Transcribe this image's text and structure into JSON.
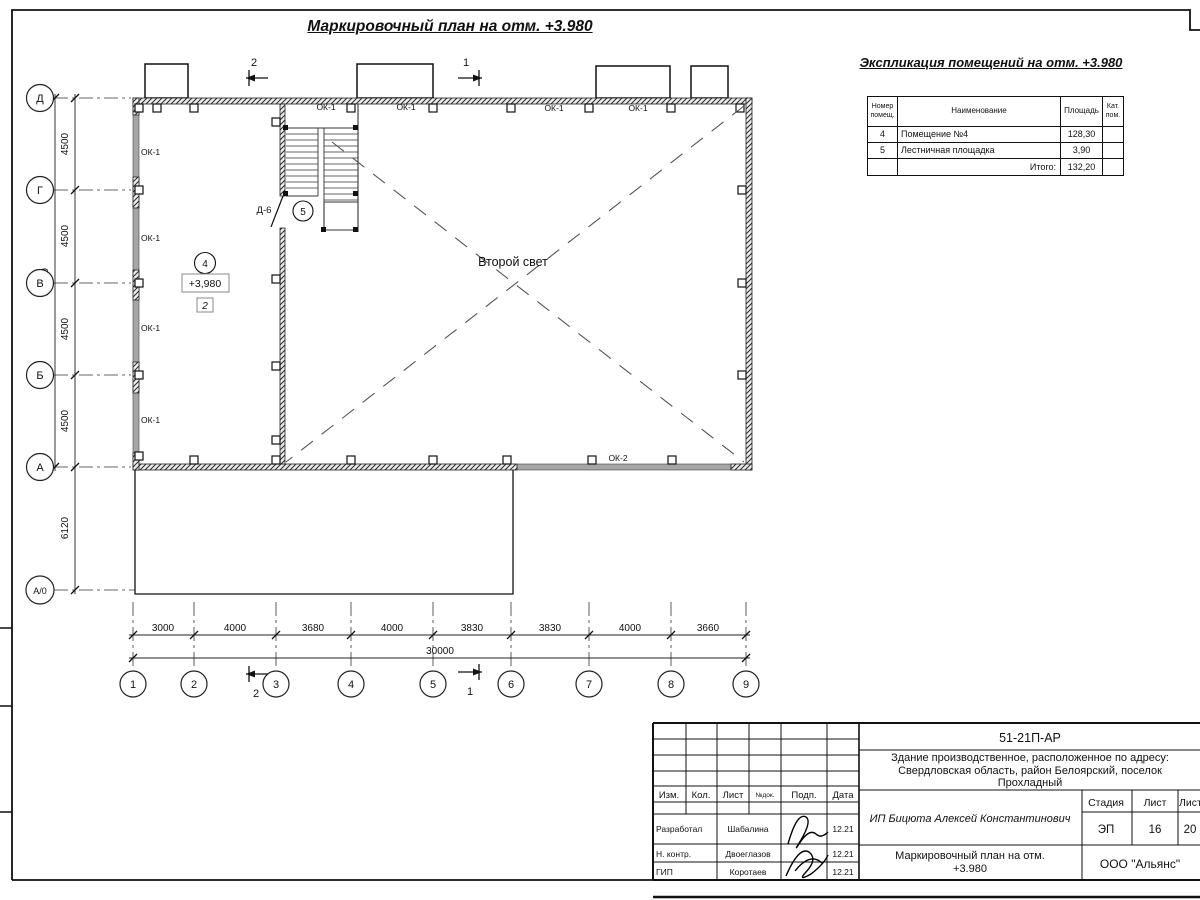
{
  "sheet": {
    "main_title": "Маркировочный план на отм. +3.980"
  },
  "exp_table": {
    "title": "Экспликация помещений на отм. +3.980",
    "col_num": "Номер помещ.",
    "col_name": "Наименование",
    "col_area": "Площадь",
    "col_cat": "Кат. пом.",
    "rows": [
      {
        "num": "4",
        "name": "Помещение №4",
        "area": "128,30",
        "cat": ""
      },
      {
        "num": "5",
        "name": "Лестничная площадка",
        "area": "3,90",
        "cat": ""
      }
    ],
    "total_label": "Итого:",
    "total_area": "132,20"
  },
  "plan": {
    "center_label": "Второй свет",
    "ok1": "ОК-1",
    "ok2": "ОК-2",
    "door": "Д-6",
    "room4": "4",
    "room5": "5",
    "elevation": "+3,980",
    "floor_type": "2",
    "sec1": "1",
    "sec2": "2"
  },
  "axes": {
    "rows": [
      "Д",
      "Г",
      "В",
      "Б",
      "А",
      "А/0"
    ],
    "cols": [
      "1",
      "2",
      "3",
      "4",
      "5",
      "6",
      "7",
      "8",
      "9"
    ],
    "row_dims": [
      "4500",
      "4500",
      "4500",
      "4500"
    ],
    "row_total": "18000",
    "lower_dim": "6120",
    "col_dims": [
      "3000",
      "4000",
      "3680",
      "4000",
      "3830",
      "3830",
      "4000",
      "3660"
    ],
    "col_total": "30000"
  },
  "title_block": {
    "doc_number": "51-21П-АР",
    "address": "Здание производственное, расположенное по адресу: Свердловская область, район Белоярский, поселок Прохладный",
    "client": "ИП Бицюта Алексей Константинович",
    "drawing_title": "Маркировочный план на отм. +3.980",
    "company": "ООО \"Альянс\"",
    "stage_label": "Стадия",
    "sheet_label": "Лист",
    "sheets_label": "Листов",
    "stage": "ЭП",
    "sheet_num": "16",
    "sheets_total": "20",
    "stamp_cols": [
      "Изм.",
      "Кол.",
      "Лист",
      "№док.",
      "Подп.",
      "Дата"
    ],
    "signers": [
      {
        "role": "Разработал",
        "name": "Шабалина",
        "date": "12.21"
      },
      {
        "role": "Н. контр.",
        "name": "Двоеглазов",
        "date": "12.21"
      },
      {
        "role": "ГИП",
        "name": "Коротаев",
        "date": "12.21"
      }
    ]
  }
}
